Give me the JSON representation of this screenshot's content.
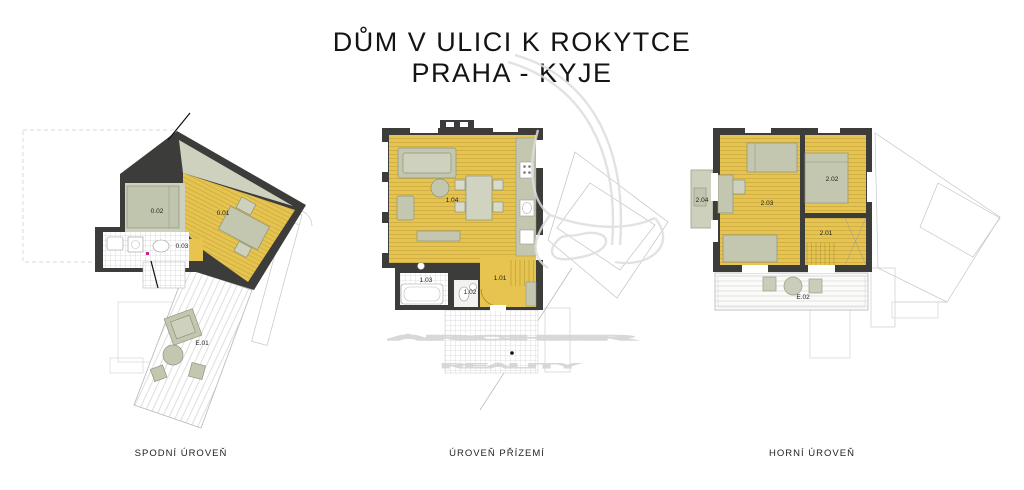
{
  "title": {
    "line1": "DŮM V ULICI K ROKYTCE",
    "line2": "PRAHA - KYJE"
  },
  "plans": [
    {
      "caption": "SPODNÍ ÚROVEŇ",
      "rooms": {
        "main": "0.01",
        "bedroom": "0.02",
        "bath": "0.03",
        "terrace": "E.01"
      }
    },
    {
      "caption": "ÚROVEŇ PŘÍZEMÍ",
      "rooms": {
        "hall": "1.01",
        "wc": "1.02",
        "bath": "1.03",
        "living": "1.04"
      }
    },
    {
      "caption": "HORNÍ ÚROVEŇ",
      "rooms": {
        "hall": "2.01",
        "bedroom2": "2.02",
        "bedroom1": "2.03",
        "balcony": "2.04",
        "terrace": "E.02"
      }
    }
  ],
  "watermark": {
    "line1": "ARCHER",
    "line2": "REALITY"
  },
  "colors": {
    "wall": "#3c3c3a",
    "floor_yellow": "#e6c44f",
    "floor_hatch": "#c2a33c",
    "furniture_sage": "#c3c7af",
    "pale_sage": "#cdd1bd",
    "site_outline": "#c5c5c5",
    "watermark_gray": "#d6d6d6"
  }
}
